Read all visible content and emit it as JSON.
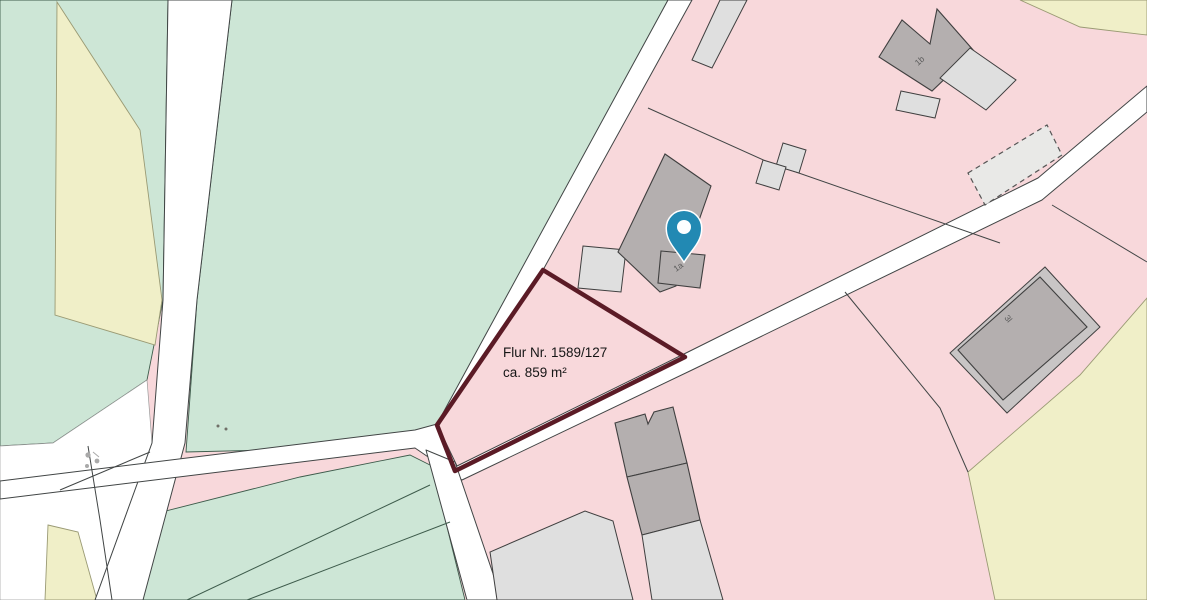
{
  "map": {
    "parcel": {
      "label_line1": "Flur Nr. 1589/127",
      "label_line2": "ca. 859 m²"
    },
    "building_labels": {
      "main": "1a",
      "north": "1b",
      "barn": "3l"
    },
    "colors": {
      "pink": "#f8d8db",
      "green": "#cde6d6",
      "yellow": "#f0efc8",
      "line": "#414545",
      "green_line": "#3d5b4b",
      "yellow_line": "#9a9a74",
      "bld_dark": "#b4afaf",
      "bld_mid": "#c8c5c5",
      "bld_light": "#dfdfdf",
      "bld_pale": "#e9e9e7",
      "outline": "#3f3f3f",
      "parcel": "#5b1b26",
      "pin": "#2289b3",
      "pin_inner": "#fdfeff",
      "label": "#5a5a5a",
      "text": "#161616"
    }
  }
}
